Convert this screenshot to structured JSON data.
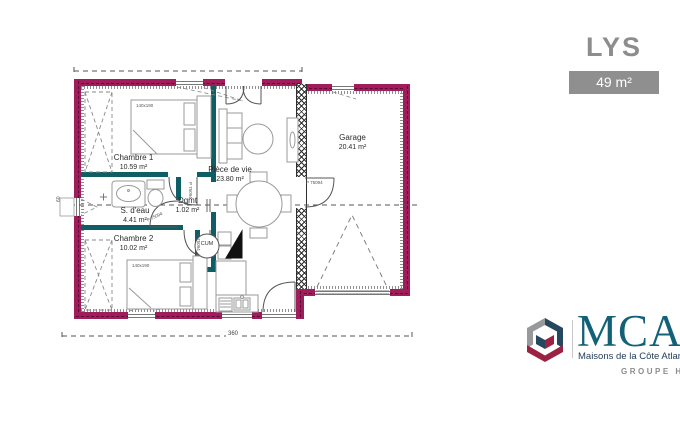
{
  "header": {
    "title": "LYS",
    "area_badge": "49 m²"
  },
  "plan": {
    "rooms": [
      {
        "name": "Chambre 1",
        "area": "10.59 m²"
      },
      {
        "name": "S. d'eau",
        "area": "4.41 m²"
      },
      {
        "name": "Dgmt",
        "area": "1.02 m²"
      },
      {
        "name": "Chambre 2",
        "area": "10.02 m²"
      },
      {
        "name": "Pièce de vie",
        "area": "23.80 m²"
      },
      {
        "name": "Garage",
        "area": "20.41 m²"
      }
    ],
    "labels": {
      "water_heater": "CUM",
      "door_ref": "P 75094",
      "bed_size": "140x190"
    },
    "dimensions": {
      "bottom_width": "360",
      "left_window": "60"
    },
    "colors": {
      "exterior_wall": "#A01C5B",
      "interior_wall": "#0E5E66"
    }
  },
  "logo": {
    "brand": "MCA",
    "tagline": "Maisons de la Côte Atlantique",
    "group": "GROUPE HEXAOM",
    "colors": {
      "brand_text": "#136179",
      "cube_gray": "#97999B",
      "cube_navy": "#25485E",
      "cube_red": "#9C2243"
    }
  }
}
